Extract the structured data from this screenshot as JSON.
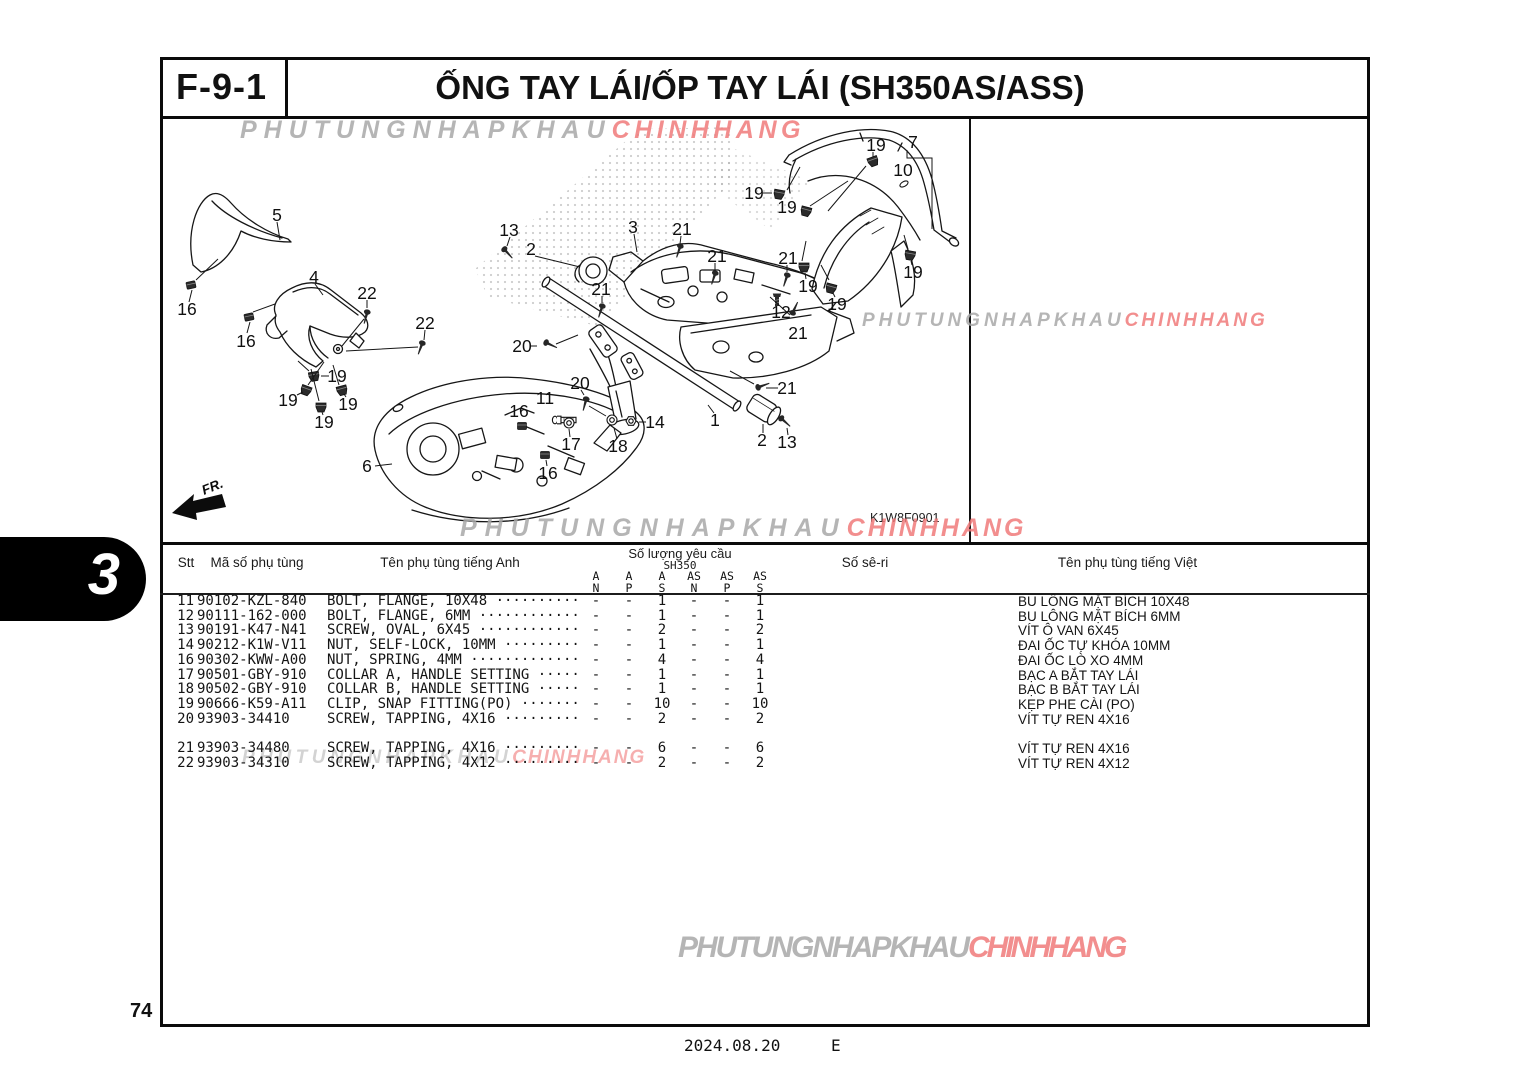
{
  "page": {
    "section_code": "F-9-1",
    "title": "ỐNG TAY LÁI/ỐP TAY LÁI (SH350AS/ASS)",
    "side_tab": "3",
    "page_number": "74",
    "footer_date": "2024.08.20",
    "footer_code": "E"
  },
  "watermark": {
    "gray_text": "PHUTUNGNHAPKHAU",
    "red_text": "CHINHHANG",
    "gray_color": "#a8a8a8",
    "red_color": "#f07a7a"
  },
  "diagram": {
    "code": "K1W8F0901",
    "fr_label": "FR.",
    "callouts": [
      {
        "t": "5",
        "x": 117,
        "y": 96
      },
      {
        "t": "16",
        "x": 27,
        "y": 190
      },
      {
        "t": "16",
        "x": 86,
        "y": 222
      },
      {
        "t": "4",
        "x": 154,
        "y": 158
      },
      {
        "t": "22",
        "x": 207,
        "y": 174
      },
      {
        "t": "22",
        "x": 265,
        "y": 204
      },
      {
        "t": "19",
        "x": 177,
        "y": 257
      },
      {
        "t": "19",
        "x": 128,
        "y": 281
      },
      {
        "t": "19",
        "x": 188,
        "y": 285
      },
      {
        "t": "19",
        "x": 164,
        "y": 303
      },
      {
        "t": "6",
        "x": 207,
        "y": 347
      },
      {
        "t": "13",
        "x": 349,
        "y": 111
      },
      {
        "t": "2",
        "x": 371,
        "y": 130
      },
      {
        "t": "3",
        "x": 473,
        "y": 108
      },
      {
        "t": "21",
        "x": 522,
        "y": 110
      },
      {
        "t": "21",
        "x": 557,
        "y": 137
      },
      {
        "t": "21",
        "x": 441,
        "y": 170
      },
      {
        "t": "21",
        "x": 628,
        "y": 139
      },
      {
        "t": "19",
        "x": 594,
        "y": 74
      },
      {
        "t": "19",
        "x": 627,
        "y": 88
      },
      {
        "t": "19",
        "x": 648,
        "y": 167
      },
      {
        "t": "12",
        "x": 621,
        "y": 193
      },
      {
        "t": "21",
        "x": 638,
        "y": 214
      },
      {
        "t": "19",
        "x": 716,
        "y": 26
      },
      {
        "t": "7",
        "x": 753,
        "y": 23
      },
      {
        "t": "10",
        "x": 743,
        "y": 51
      },
      {
        "t": "19",
        "x": 753,
        "y": 153
      },
      {
        "t": "19",
        "x": 677,
        "y": 185
      },
      {
        "t": "20",
        "x": 362,
        "y": 227
      },
      {
        "t": "20",
        "x": 420,
        "y": 264
      },
      {
        "t": "11",
        "x": 385,
        "y": 279
      },
      {
        "t": "16",
        "x": 359,
        "y": 292
      },
      {
        "t": "17",
        "x": 411,
        "y": 325
      },
      {
        "t": "18",
        "x": 458,
        "y": 327
      },
      {
        "t": "14",
        "x": 495,
        "y": 303
      },
      {
        "t": "1",
        "x": 555,
        "y": 301
      },
      {
        "t": "2",
        "x": 602,
        "y": 321
      },
      {
        "t": "13",
        "x": 627,
        "y": 323
      },
      {
        "t": "16",
        "x": 388,
        "y": 354
      },
      {
        "t": "21",
        "x": 627,
        "y": 269
      }
    ]
  },
  "table": {
    "headers": {
      "stt": "Stt",
      "code": "Mã số phụ tùng",
      "name_en": "Tên phụ tùng tiếng Anh",
      "qty_group": "Số lượng yêu cầu",
      "qty_model": "SH350",
      "qty_cols": [
        [
          "A",
          "N"
        ],
        [
          "A",
          "P"
        ],
        [
          "A",
          "S"
        ],
        [
          "AS",
          "N"
        ],
        [
          "AS",
          "P"
        ],
        [
          "AS",
          "S"
        ]
      ],
      "serial": "Số sê-ri",
      "name_vi": "Tên phụ tùng tiếng Việt"
    },
    "rows": [
      {
        "stt": "11",
        "code": "90102-KZL-840",
        "name_en": "BOLT, FLANGE, 10X48",
        "dots": "··········",
        "qty": [
          "-",
          "-",
          "1",
          "-",
          "-",
          "1"
        ],
        "name_vi": "BU LÔNG MẶT BÍCH 10X48",
        "gap_before": false
      },
      {
        "stt": "12",
        "code": "90111-162-000",
        "name_en": "BOLT, FLANGE, 6MM",
        "dots": "············",
        "qty": [
          "-",
          "-",
          "1",
          "-",
          "-",
          "1"
        ],
        "name_vi": "BU LÔNG MẶT BÍCH 6MM",
        "gap_before": false
      },
      {
        "stt": "13",
        "code": "90191-K47-N41",
        "name_en": "SCREW, OVAL, 6X45",
        "dots": "············",
        "qty": [
          "-",
          "-",
          "2",
          "-",
          "-",
          "2"
        ],
        "name_vi": "VÍT Ô VAN 6X45",
        "gap_before": false
      },
      {
        "stt": "14",
        "code": "90212-K1W-V11",
        "name_en": "NUT, SELF-LOCK, 10MM",
        "dots": "·········",
        "qty": [
          "-",
          "-",
          "1",
          "-",
          "-",
          "1"
        ],
        "name_vi": "ĐAI ỐC TỰ KHÓA 10MM",
        "gap_before": false
      },
      {
        "stt": "16",
        "code": "90302-KWW-A00",
        "name_en": "NUT, SPRING, 4MM",
        "dots": "·············",
        "qty": [
          "-",
          "-",
          "4",
          "-",
          "-",
          "4"
        ],
        "name_vi": "ĐAI ỐC LÒ XO 4MM",
        "gap_before": false
      },
      {
        "stt": "17",
        "code": "90501-GBY-910",
        "name_en": "COLLAR A, HANDLE SETTING",
        "dots": "·····",
        "qty": [
          "-",
          "-",
          "1",
          "-",
          "-",
          "1"
        ],
        "name_vi": "BẠC A BẮT TAY LÁI",
        "gap_before": false
      },
      {
        "stt": "18",
        "code": "90502-GBY-910",
        "name_en": "COLLAR B, HANDLE SETTING",
        "dots": "·····",
        "qty": [
          "-",
          "-",
          "1",
          "-",
          "-",
          "1"
        ],
        "name_vi": "BẠC B BẮT TAY LÁI",
        "gap_before": false
      },
      {
        "stt": "19",
        "code": "90666-K59-A11",
        "name_en": "CLIP, SNAP FITTING(PO)",
        "dots": "·······",
        "qty": [
          "-",
          "-",
          "10",
          "-",
          "-",
          "10"
        ],
        "name_vi": "KẸP PHE CÀI (PO)",
        "gap_before": false
      },
      {
        "stt": "20",
        "code": "93903-34410",
        "name_en": "SCREW, TAPPING, 4X16",
        "dots": "·········",
        "qty": [
          "-",
          "-",
          "2",
          "-",
          "-",
          "2"
        ],
        "name_vi": "VÍT TỰ REN 4X16",
        "gap_before": false
      },
      {
        "stt": "21",
        "code": "93903-34480",
        "name_en": "SCREW, TAPPING, 4X16",
        "dots": "·········",
        "qty": [
          "-",
          "-",
          "6",
          "-",
          "-",
          "6"
        ],
        "name_vi": "VÍT TỰ REN 4X16",
        "gap_before": true
      },
      {
        "stt": "22",
        "code": "93903-34310",
        "name_en": "SCREW, TAPPING, 4X12",
        "dots": "·········",
        "qty": [
          "-",
          "-",
          "2",
          "-",
          "-",
          "2"
        ],
        "name_vi": "VÍT TỰ REN 4X12",
        "gap_before": false
      }
    ]
  }
}
